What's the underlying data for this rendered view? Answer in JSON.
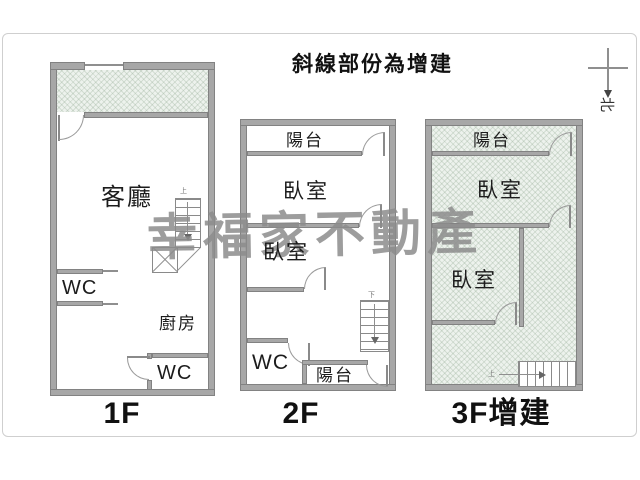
{
  "title": "斜線部份為增建",
  "compass": {
    "north_char": "北"
  },
  "watermark": "幸福家不動產",
  "floors": {
    "f1": {
      "label": "1F",
      "living": "客廳",
      "wc_upper": "WC",
      "kitchen": "廚房",
      "wc_lower": "WC"
    },
    "f2": {
      "label": "2F",
      "balcony_top": "陽台",
      "bedroom1": "臥室",
      "bedroom2": "臥室",
      "wc": "WC",
      "balcony_bottom": "陽台"
    },
    "f3": {
      "label": "3F增建",
      "balcony": "陽台",
      "bedroom1": "臥室",
      "bedroom2": "臥室"
    }
  },
  "stairs": {
    "up": "上",
    "down": "下"
  },
  "legend_meaning": "hatched area = addition",
  "colors": {
    "wall": "#a7a7a7",
    "hatch_bg": "#edf2ed",
    "watermark": "#8c8c8c",
    "line": "#8f8f8f"
  }
}
